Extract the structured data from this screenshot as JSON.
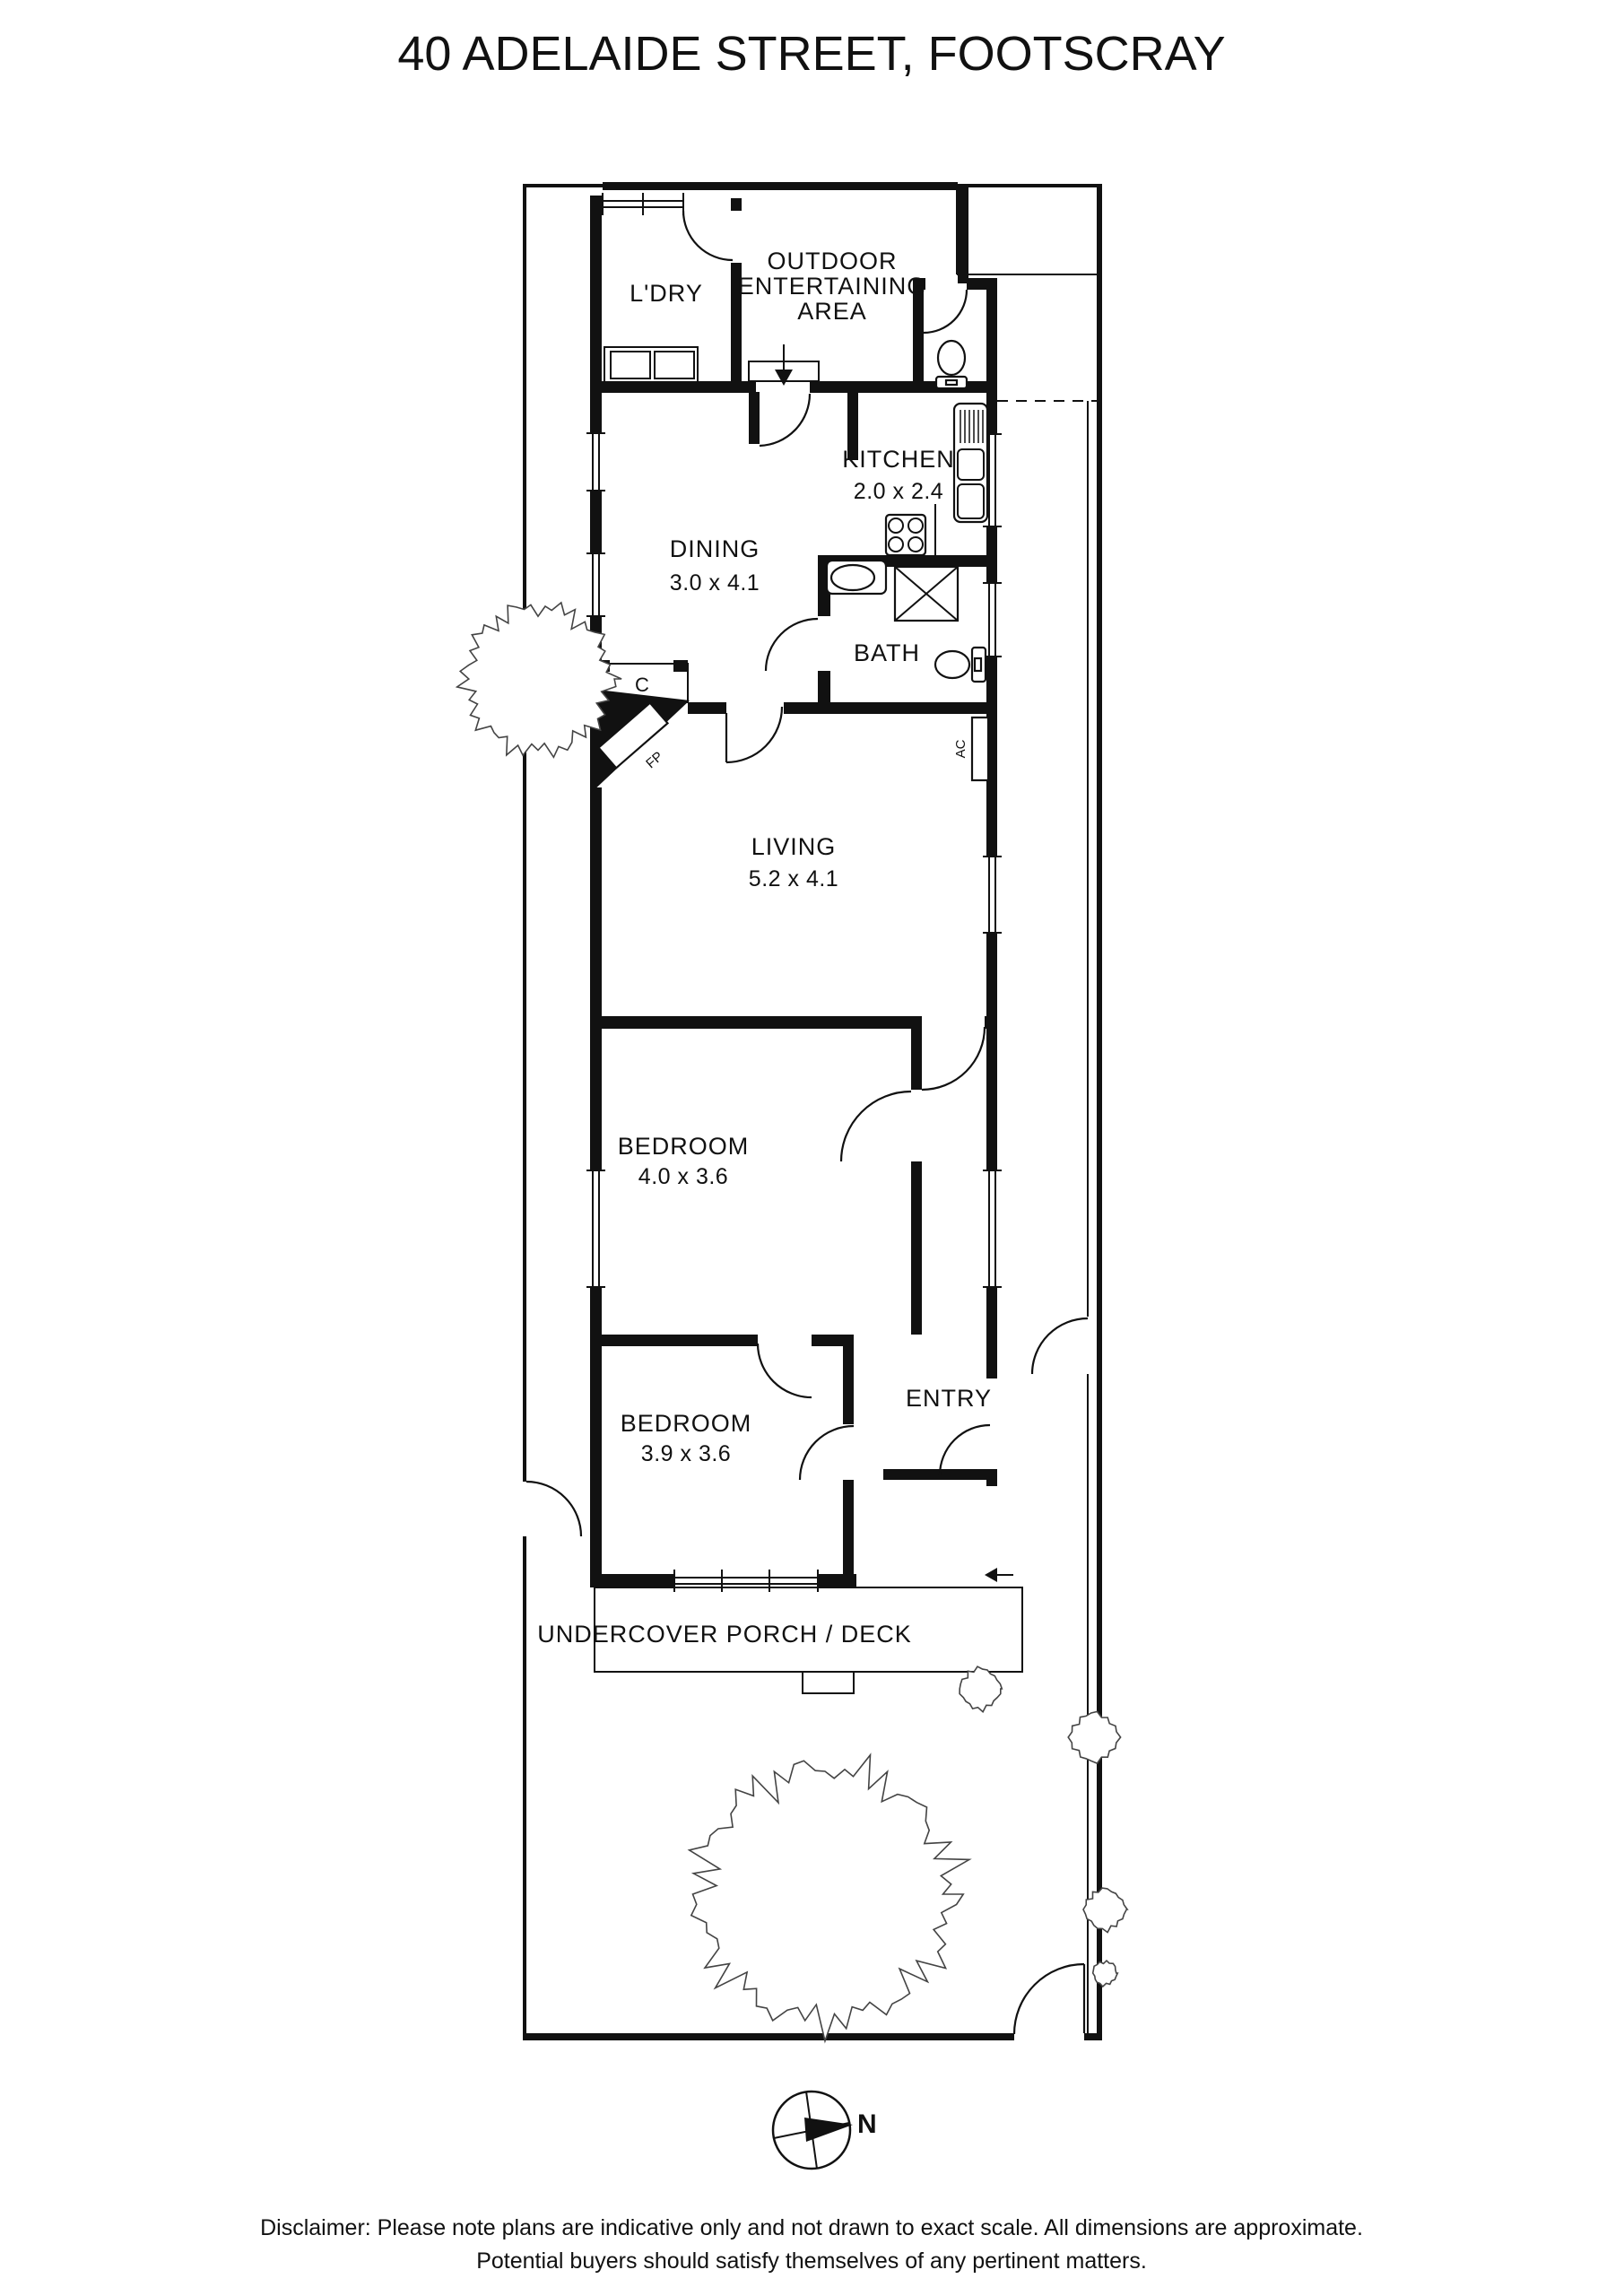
{
  "title": "40 ADELAIDE STREET, FOOTSCRAY",
  "floorplan": {
    "rooms": [
      {
        "name": "L'DRY",
        "dims": ""
      },
      {
        "name": "OUTDOOR ENTERTAINING AREA",
        "dims": ""
      },
      {
        "name": "KITCHEN",
        "dims": "2.0 x 2.4"
      },
      {
        "name": "DINING",
        "dims": "3.0 x 4.1"
      },
      {
        "name": "BATH",
        "dims": ""
      },
      {
        "name": "LIVING",
        "dims": "5.2 x 4.1"
      },
      {
        "name": "BEDROOM",
        "dims": "4.0 x 3.6"
      },
      {
        "name": "BEDROOM",
        "dims": "3.9 x 3.6"
      },
      {
        "name": "ENTRY",
        "dims": ""
      },
      {
        "name": "UNDERCOVER PORCH / DECK",
        "dims": ""
      }
    ],
    "labels": {
      "ldry": "L'DRY",
      "outdoor_line1": "OUTDOOR",
      "outdoor_line2": "ENTERTAINING",
      "outdoor_line3": "AREA",
      "kitchen": "KITCHEN",
      "kitchen_dims": "2.0 x 2.4",
      "dining": "DINING",
      "dining_dims": "3.0 x 4.1",
      "bath": "BATH",
      "living": "LIVING",
      "living_dims": "5.2 x 4.1",
      "bedroom1": "BEDROOM",
      "bedroom1_dims": "4.0 x 3.6",
      "bedroom2": "BEDROOM",
      "bedroom2_dims": "3.9 x 3.6",
      "entry": "ENTRY",
      "porch": "UNDERCOVER PORCH / DECK",
      "closet": "C",
      "fireplace": "FP",
      "ac": "AC"
    },
    "compass": {
      "north": "N"
    }
  },
  "disclaimer": {
    "line1": "Disclaimer: Please note plans are indicative only and not drawn to exact scale. All dimensions are approximate.",
    "line2": "Potential buyers should satisfy themselves of any pertinent matters."
  },
  "colors": {
    "ink": "#111111",
    "background": "#ffffff"
  }
}
